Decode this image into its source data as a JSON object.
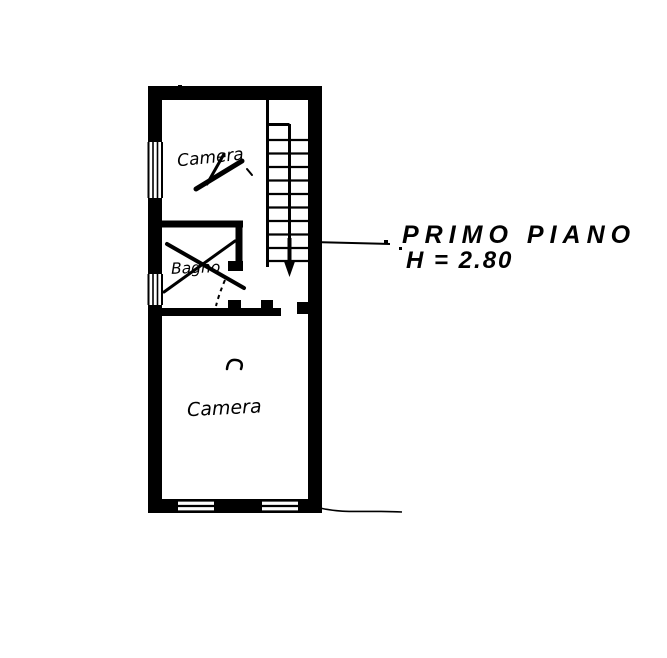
{
  "page": {
    "kind": "scanned hand-drawn floor plan",
    "background_color": "#ffffff",
    "ink_color": "#000000"
  },
  "plan": {
    "title": "PRIMO PIANO",
    "height_note": "H = 2.80",
    "rooms": [
      {
        "label": "Camera"
      },
      {
        "label": "Bagno"
      },
      {
        "label": "Camera"
      }
    ],
    "stairs": {
      "treads": 10,
      "direction_arrow": "down"
    },
    "windows": {
      "left_wall_count": 2,
      "bottom_wall_count": 2
    }
  }
}
